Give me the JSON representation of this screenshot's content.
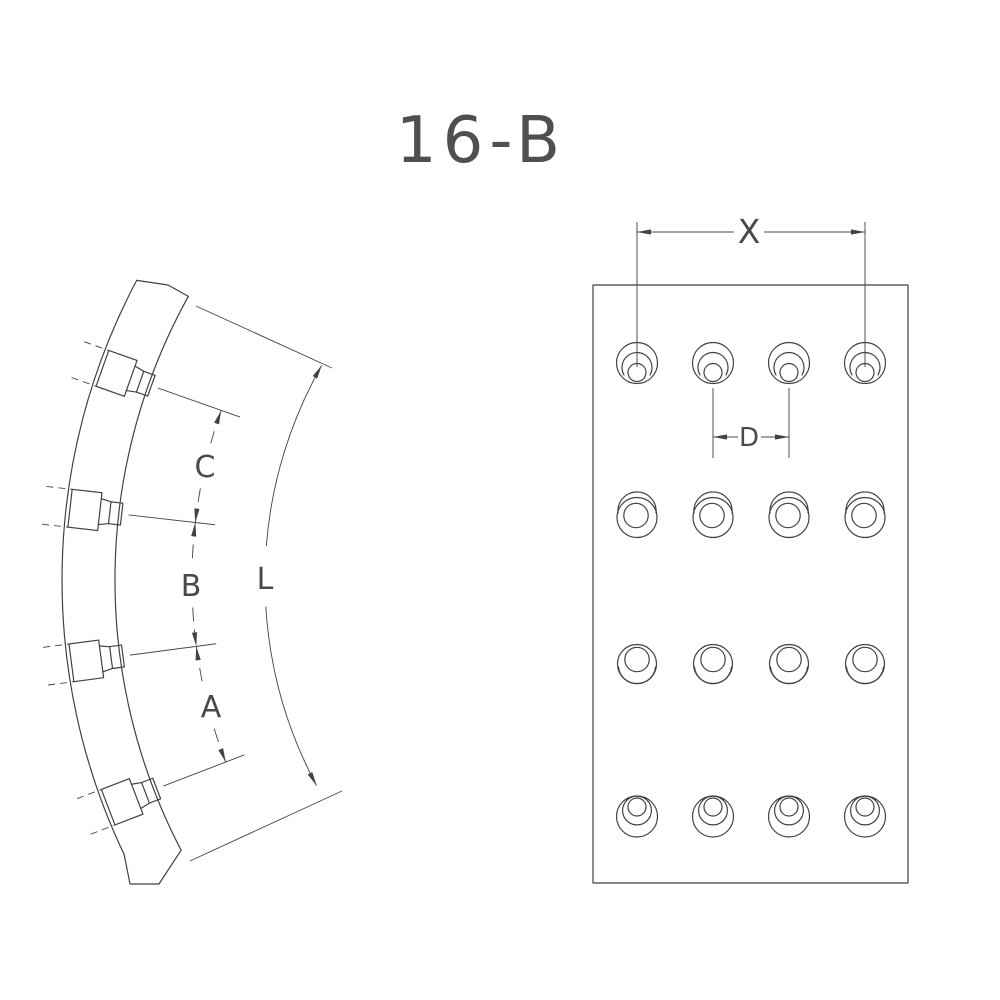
{
  "drawing": {
    "title": "16-B",
    "background_color": "#ffffff",
    "line_color": "#424242"
  },
  "side_view": {
    "hole_count": 4,
    "dim_labels": {
      "c": "C",
      "b": "B",
      "a": "A",
      "l": "L"
    }
  },
  "face_view": {
    "hole_rows": 4,
    "hole_cols": 4,
    "hole_total": 16,
    "dim_labels": {
      "x": "X",
      "d": "D"
    }
  }
}
